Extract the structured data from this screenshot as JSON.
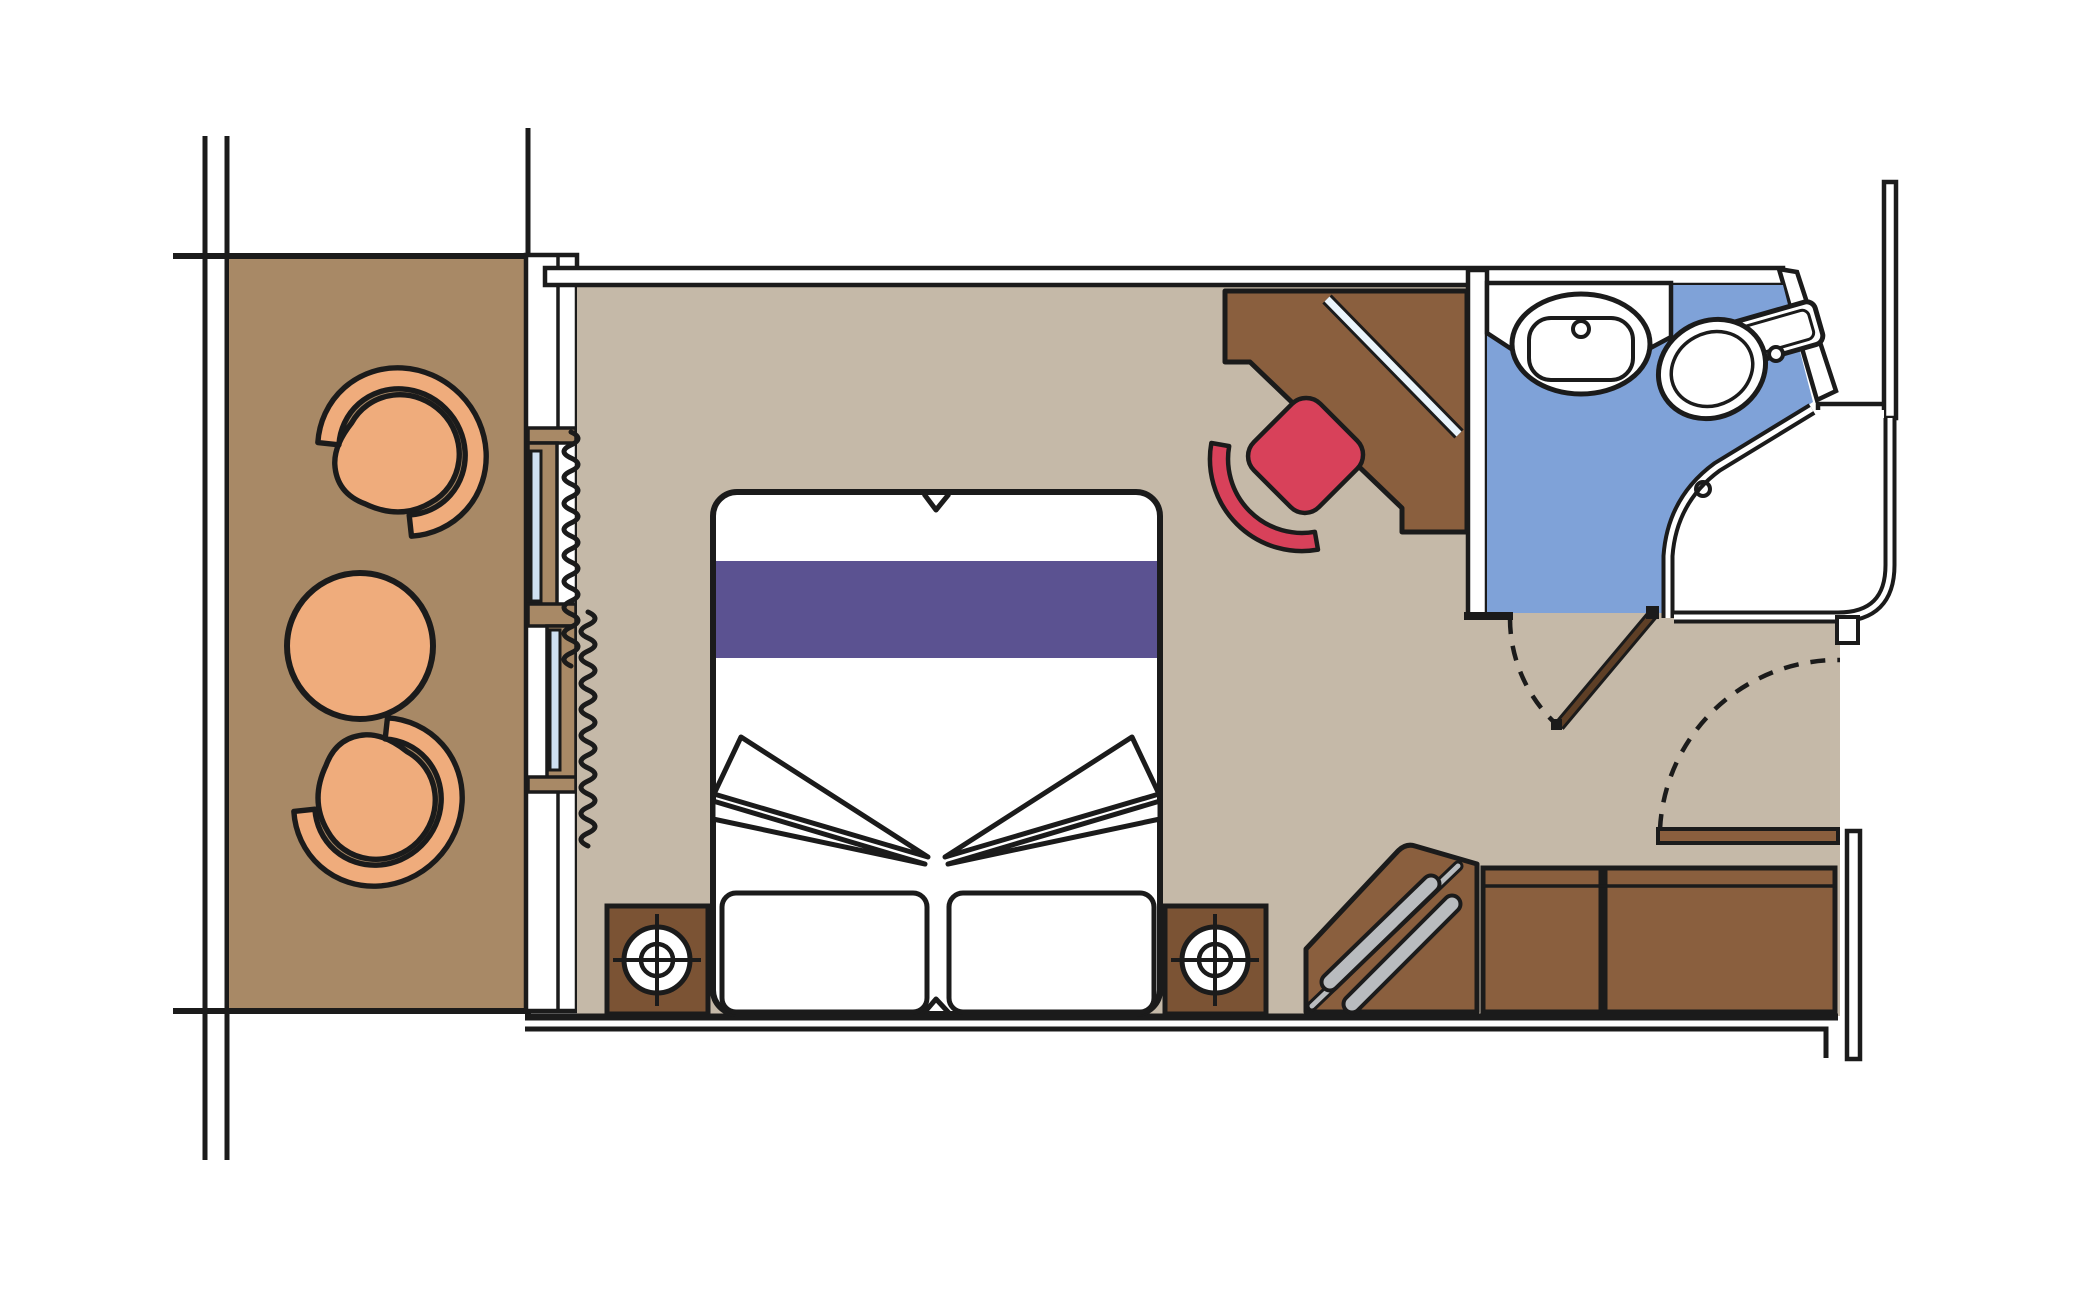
{
  "meta": {
    "title": "Cruise ship cabin floor plan (top-down)",
    "canvas": {
      "width": 2100,
      "height": 1299
    },
    "text_content": "none — drawing only, no visible text labels"
  },
  "colors": {
    "line": "#1b1b1b",
    "white": "#ffffff",
    "balcony_floor": "#a88966",
    "cabin_floor": "#c5b9a8",
    "furniture_brown": "#8a5f3e",
    "nightstand_brown": "#7b5334",
    "door_leaf_brown": "#5e3f26",
    "chair_orange": "#efac7c",
    "bathroom_blue": "#7fa2d8",
    "glass_blue": "#cfe0f1",
    "bed_runner_purple": "#5b5291",
    "desk_chair_red": "#d8415a",
    "hanger_gray": "#b9bcbf",
    "shelf_stripe": "#eaf4fb"
  },
  "regions": {
    "balcony": {
      "name": "balcony",
      "items": [
        "armchair-upper",
        "round-table",
        "armchair-lower"
      ],
      "window": "sliding glass door, two offset panels with curtain squiggles inside"
    },
    "cabin": {
      "name": "main-cabin",
      "items": [
        "double-bed-with-purple-runner",
        "two-pillows",
        "folded-sheet-wedges",
        "nightstand-left-with-lamp",
        "nightstand-right-with-lamp",
        "corner-desk-with-glass-shelf",
        "red-desk-chair",
        "corner-wardrobe-with-hangers",
        "wardrobe-cabinets"
      ]
    },
    "bathroom": {
      "name": "bathroom",
      "items": [
        "vanity-counter",
        "oval-sink-with-faucet",
        "toilet-with-tank",
        "corner-shower-with-drain",
        "inward-swinging-door-with-dashed-arc"
      ]
    },
    "entrance": {
      "name": "cabin-entrance",
      "items": [
        "open-entry-door-leaf",
        "dashed-door-swing-arc",
        "corridor-wall"
      ]
    }
  }
}
